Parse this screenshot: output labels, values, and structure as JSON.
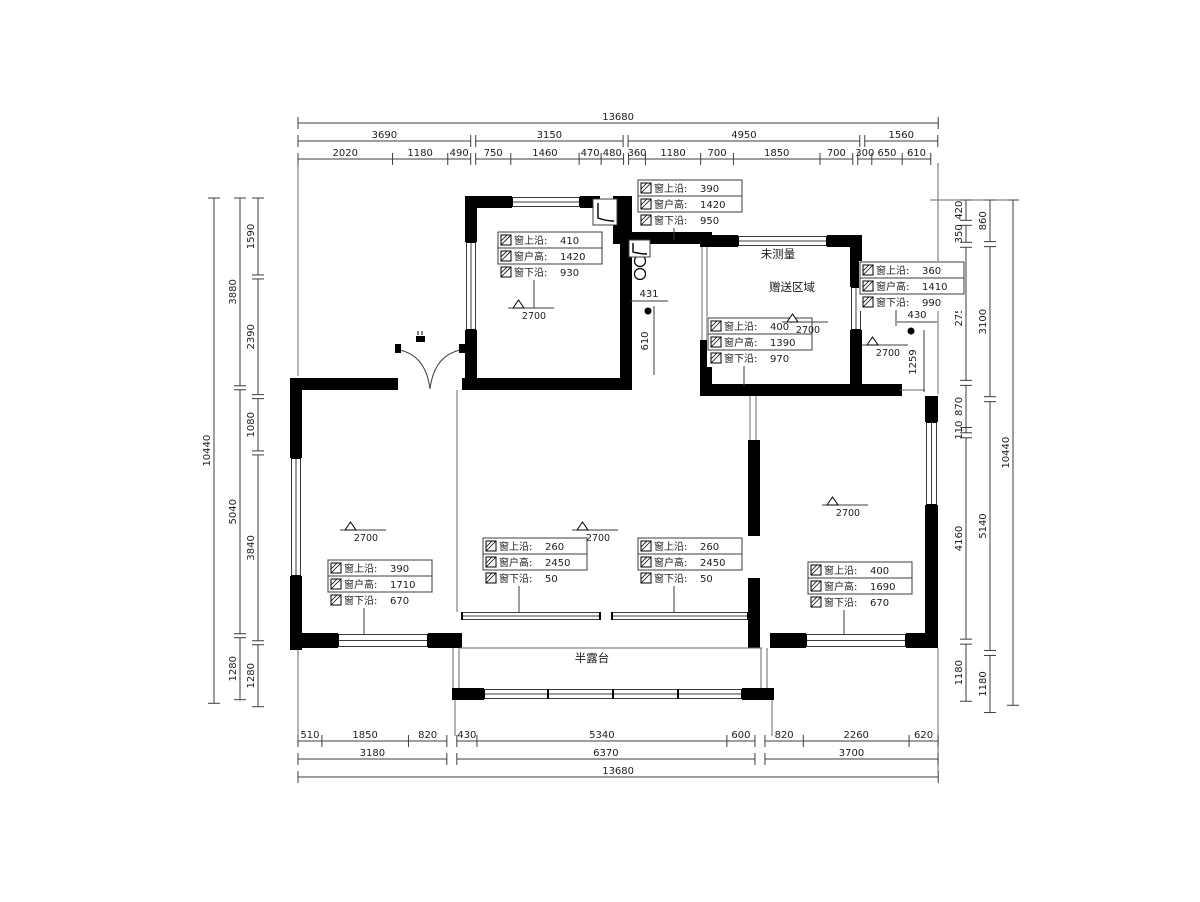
{
  "page": {
    "background": "#ffffff"
  },
  "colors": {
    "wall": "#000000",
    "line": "#3c3c3c",
    "thin": "#6a6a6a",
    "text": "#1c1c1c"
  },
  "labels": {
    "room_not_measured": "未测量",
    "room_bonus_area": "赠送区域",
    "room_half_terrace": "半露台",
    "win_top": "窗上沿",
    "win_height": "窗户高",
    "win_bottom": "窗下沿"
  },
  "room_labels": [
    {
      "text": "未测量",
      "x": 778,
      "y": 258
    },
    {
      "text": "赠送区域",
      "x": 792,
      "y": 291
    },
    {
      "text": "半露台",
      "x": 592,
      "y": 662
    }
  ],
  "dimension_chains": {
    "top": {
      "rows": [
        {
          "name": "overall",
          "groups": [
            [
              "13680"
            ]
          ]
        },
        {
          "name": "mid",
          "groups": [
            [
              "3690"
            ],
            [
              "3150"
            ],
            [
              "4950"
            ],
            [
              "1560"
            ]
          ]
        },
        {
          "name": "detail",
          "groups": [
            [
              "2020",
              "1180",
              "490"
            ],
            [
              "750",
              "1460",
              "470",
              "480"
            ],
            [
              "360",
              "1180",
              "700",
              "1850",
              "700"
            ],
            [
              "300",
              "650",
              "610"
            ]
          ]
        }
      ]
    },
    "bottom": {
      "rows": [
        {
          "name": "detail",
          "groups": [
            [
              "510",
              "1850",
              "820"
            ],
            [
              "430",
              "5340",
              "600"
            ],
            [
              "820",
              "2260",
              "620"
            ]
          ]
        },
        {
          "name": "mid",
          "groups": [
            [
              "3180"
            ],
            [
              "6370"
            ],
            [
              "3700"
            ]
          ]
        },
        {
          "name": "overall",
          "groups": [
            [
              "13680"
            ]
          ]
        }
      ]
    },
    "left": {
      "rows": [
        {
          "name": "overall",
          "groups": [
            [
              "10440"
            ]
          ]
        },
        {
          "name": "mid",
          "groups": [
            [
              "3880"
            ],
            [
              "5040"
            ],
            [
              "1280"
            ]
          ]
        },
        {
          "name": "detail",
          "groups": [
            [
              "1590"
            ],
            [
              "2390"
            ],
            [
              "1080"
            ],
            [
              "3840"
            ],
            [
              "1280"
            ]
          ]
        }
      ]
    },
    "right": {
      "rows": [
        {
          "name": "detail",
          "groups": [
            [
              "420"
            ],
            [
              "350"
            ],
            [
              "2750"
            ],
            [
              "870",
              "110"
            ],
            [
              "4160"
            ],
            [
              "1180"
            ]
          ]
        },
        {
          "name": "mid",
          "groups": [
            [
              "860"
            ],
            [
              "3100"
            ],
            [
              "5140"
            ],
            [
              "1180"
            ]
          ]
        },
        {
          "name": "overall",
          "groups": [
            [
              "10440"
            ]
          ]
        }
      ]
    }
  },
  "window_annotations": [
    {
      "id": "win-hall-top",
      "x": 638,
      "y": 180,
      "top": "390",
      "height": "1420",
      "bottom": "950",
      "leader": 12
    },
    {
      "id": "win-room-a",
      "x": 498,
      "y": 232,
      "top": "410",
      "height": "1420",
      "bottom": "930",
      "leader": 28
    },
    {
      "id": "win-bonus-right",
      "x": 860,
      "y": 262,
      "top": "360",
      "height": "1410",
      "bottom": "990",
      "leader": 16
    },
    {
      "id": "win-bonus",
      "x": 708,
      "y": 318,
      "top": "400",
      "height": "1390",
      "bottom": "970",
      "leader": 20
    },
    {
      "id": "win-left-room",
      "x": 328,
      "y": 560,
      "top": "390",
      "height": "1710",
      "bottom": "670",
      "leader": 26
    },
    {
      "id": "win-living-left",
      "x": 483,
      "y": 538,
      "top": "260",
      "height": "2450",
      "bottom": "50",
      "leader": 26
    },
    {
      "id": "win-living-right",
      "x": 638,
      "y": 538,
      "top": "260",
      "height": "2450",
      "bottom": "50",
      "leader": 26
    },
    {
      "id": "win-right-room",
      "x": 808,
      "y": 562,
      "top": "400",
      "height": "1690",
      "bottom": "670",
      "leader": 24
    }
  ],
  "height_markers": [
    {
      "value": "2700",
      "x": 340,
      "y": 530
    },
    {
      "value": "2700",
      "x": 508,
      "y": 308
    },
    {
      "value": "2700",
      "x": 572,
      "y": 530
    },
    {
      "value": "2700",
      "x": 782,
      "y": 322
    },
    {
      "value": "2700",
      "x": 822,
      "y": 505
    },
    {
      "value": "2700",
      "x": 862,
      "y": 345
    }
  ],
  "misc_dimensions": [
    {
      "value": "431",
      "x": 649,
      "y": 297,
      "orient": "h"
    },
    {
      "value": "610",
      "x": 648,
      "y": 341,
      "orient": "v"
    },
    {
      "value": "430",
      "x": 917,
      "y": 318,
      "orient": "h"
    },
    {
      "value": "1259",
      "x": 916,
      "y": 362,
      "orient": "v"
    }
  ]
}
